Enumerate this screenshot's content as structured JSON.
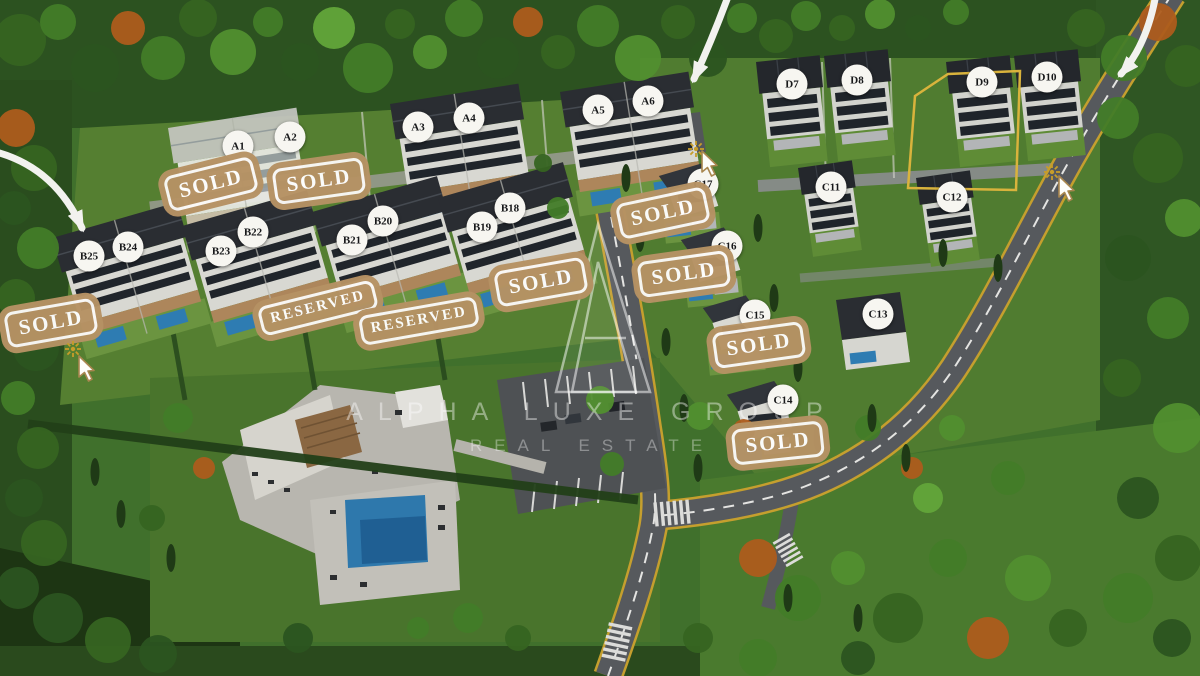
{
  "watermark": {
    "brand": "ALPHA LUXE GROUP",
    "tagline": "REAL ESTATE"
  },
  "highlight": {
    "villa_id": "D9",
    "outline_color": "#d9b33c"
  },
  "colors": {
    "stamp_tan": "#b69264",
    "label_bg": "#f7f6f1",
    "label_text": "#17181a"
  },
  "villas": [
    {
      "id": "A1",
      "x": 238,
      "y": 146
    },
    {
      "id": "A2",
      "x": 290,
      "y": 137
    },
    {
      "id": "A3",
      "x": 418,
      "y": 127
    },
    {
      "id": "A4",
      "x": 469,
      "y": 118
    },
    {
      "id": "A5",
      "x": 598,
      "y": 110
    },
    {
      "id": "A6",
      "x": 648,
      "y": 101
    },
    {
      "id": "B25",
      "x": 89,
      "y": 256
    },
    {
      "id": "B24",
      "x": 128,
      "y": 247
    },
    {
      "id": "B23",
      "x": 221,
      "y": 251
    },
    {
      "id": "B22",
      "x": 253,
      "y": 232
    },
    {
      "id": "B21",
      "x": 352,
      "y": 240
    },
    {
      "id": "B20",
      "x": 383,
      "y": 221
    },
    {
      "id": "B19",
      "x": 482,
      "y": 227
    },
    {
      "id": "B18",
      "x": 510,
      "y": 208
    },
    {
      "id": "C17",
      "x": 703,
      "y": 184
    },
    {
      "id": "C16",
      "x": 727,
      "y": 246
    },
    {
      "id": "C15",
      "x": 755,
      "y": 315
    },
    {
      "id": "C14",
      "x": 783,
      "y": 400
    },
    {
      "id": "C13",
      "x": 878,
      "y": 314
    },
    {
      "id": "C11",
      "x": 831,
      "y": 187
    },
    {
      "id": "C12",
      "x": 952,
      "y": 197
    },
    {
      "id": "D7",
      "x": 792,
      "y": 84
    },
    {
      "id": "D8",
      "x": 857,
      "y": 80
    },
    {
      "id": "D9",
      "x": 982,
      "y": 82
    },
    {
      "id": "D10",
      "x": 1047,
      "y": 77
    }
  ],
  "stamps": [
    {
      "text": "SOLD",
      "x": 211,
      "y": 184,
      "rot": -14
    },
    {
      "text": "SOLD",
      "x": 319,
      "y": 181,
      "rot": -8
    },
    {
      "text": "SOLD",
      "x": 51,
      "y": 323,
      "rot": -10
    },
    {
      "text": "RESERVED",
      "x": 318,
      "y": 308,
      "rot": -14
    },
    {
      "text": "RESERVED",
      "x": 419,
      "y": 321,
      "rot": -10
    },
    {
      "text": "SOLD",
      "x": 541,
      "y": 282,
      "rot": -10
    },
    {
      "text": "SOLD",
      "x": 663,
      "y": 213,
      "rot": -12
    },
    {
      "text": "SOLD",
      "x": 684,
      "y": 274,
      "rot": -8
    },
    {
      "text": "SOLD",
      "x": 759,
      "y": 345,
      "rot": -8
    },
    {
      "text": "SOLD",
      "x": 778,
      "y": 443,
      "rot": -6
    }
  ]
}
